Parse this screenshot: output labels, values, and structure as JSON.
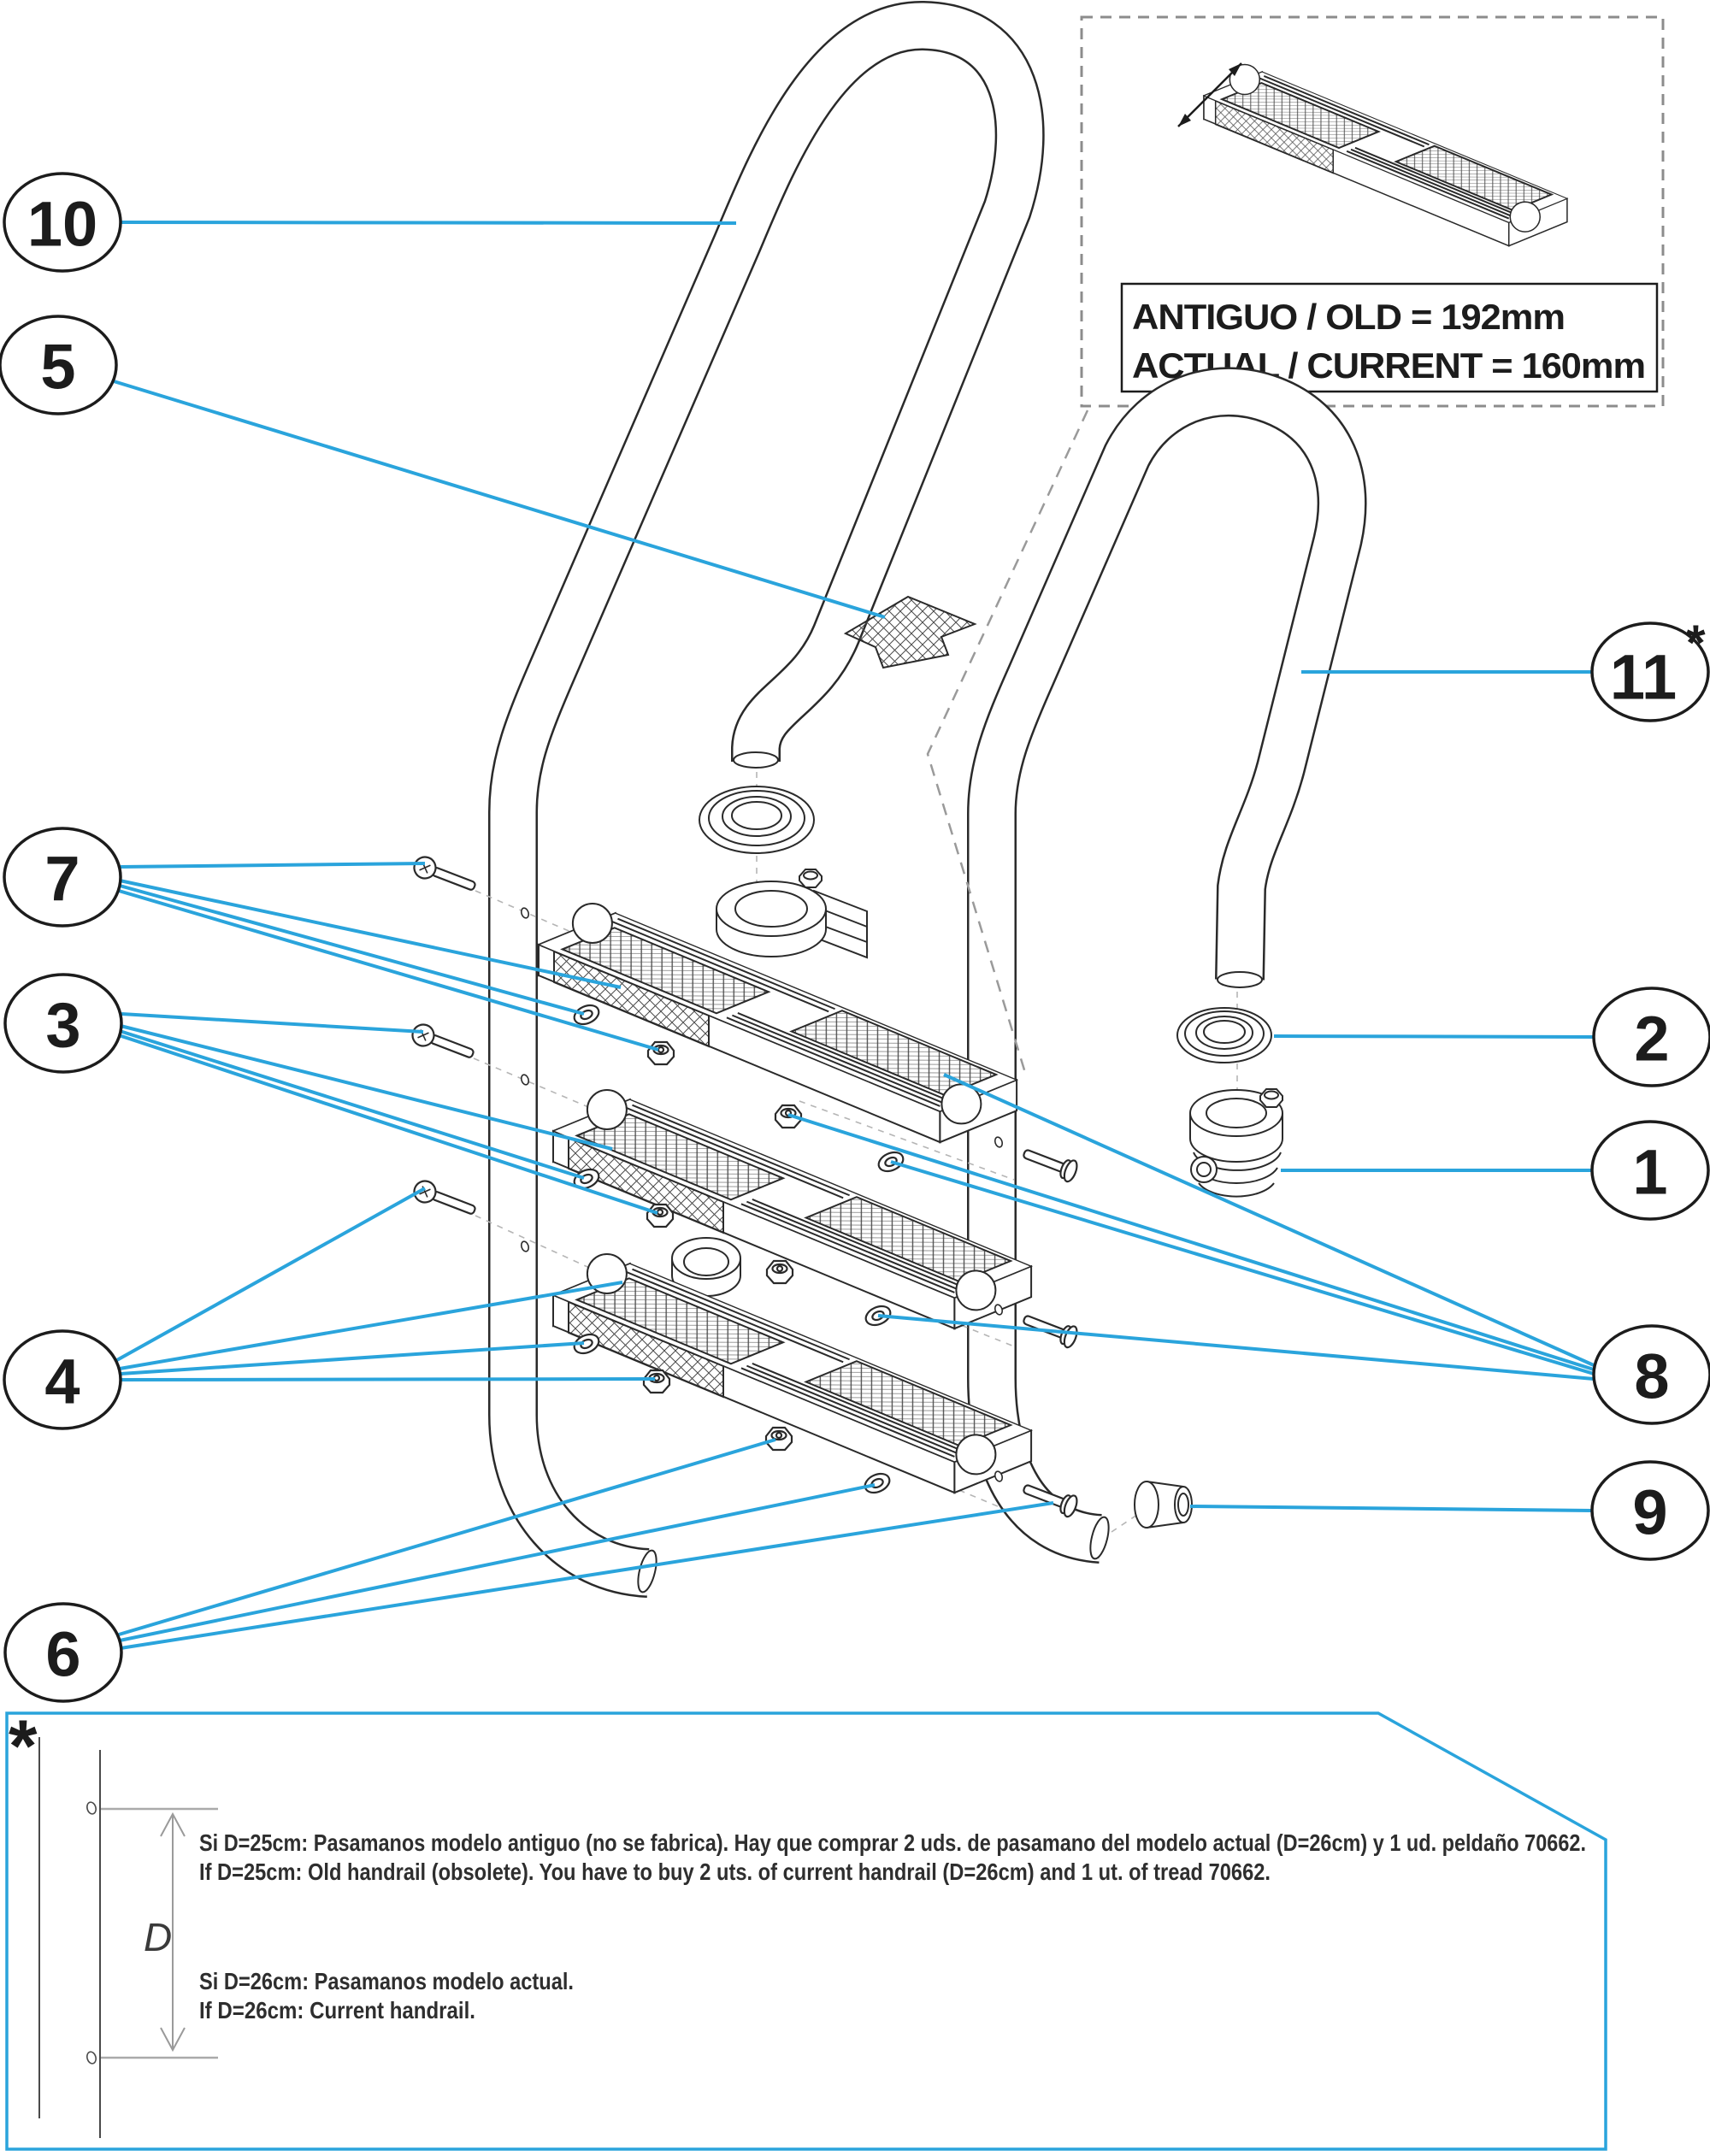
{
  "colors": {
    "leader_blue": "#2aa4dc",
    "line_dark": "#2a2a2a",
    "dash_gray": "#9a9a9a",
    "note_border_blue": "#2aa4dc"
  },
  "callouts": {
    "n1": {
      "label": "1"
    },
    "n2": {
      "label": "2"
    },
    "n3": {
      "label": "3"
    },
    "n4": {
      "label": "4"
    },
    "n5": {
      "label": "5"
    },
    "n6": {
      "label": "6"
    },
    "n7": {
      "label": "7"
    },
    "n8": {
      "label": "8"
    },
    "n9": {
      "label": "9"
    },
    "n10": {
      "label": "10"
    },
    "n11": {
      "label": "11",
      "sup": "*"
    }
  },
  "inset": {
    "line1": "ANTIGUO / OLD = 192mm",
    "line2": "ACTUAL / CURRENT = 160mm"
  },
  "footnote": {
    "marker": "*",
    "dim_label": "D",
    "line1": "Si D=25cm: Pasamanos modelo antiguo (no se fabrica). Hay que comprar 2 uds. de pasamano del modelo actual (D=26cm) y 1 ud. peldaño 70662.",
    "line2": "If D=25cm: Old handrail (obsolete). You have to buy 2 uts. of current handrail (D=26cm) and 1 ut. of tread 70662.",
    "line3": "Si D=26cm: Pasamanos modelo actual.",
    "line4": "If D=26cm: Current handrail."
  }
}
